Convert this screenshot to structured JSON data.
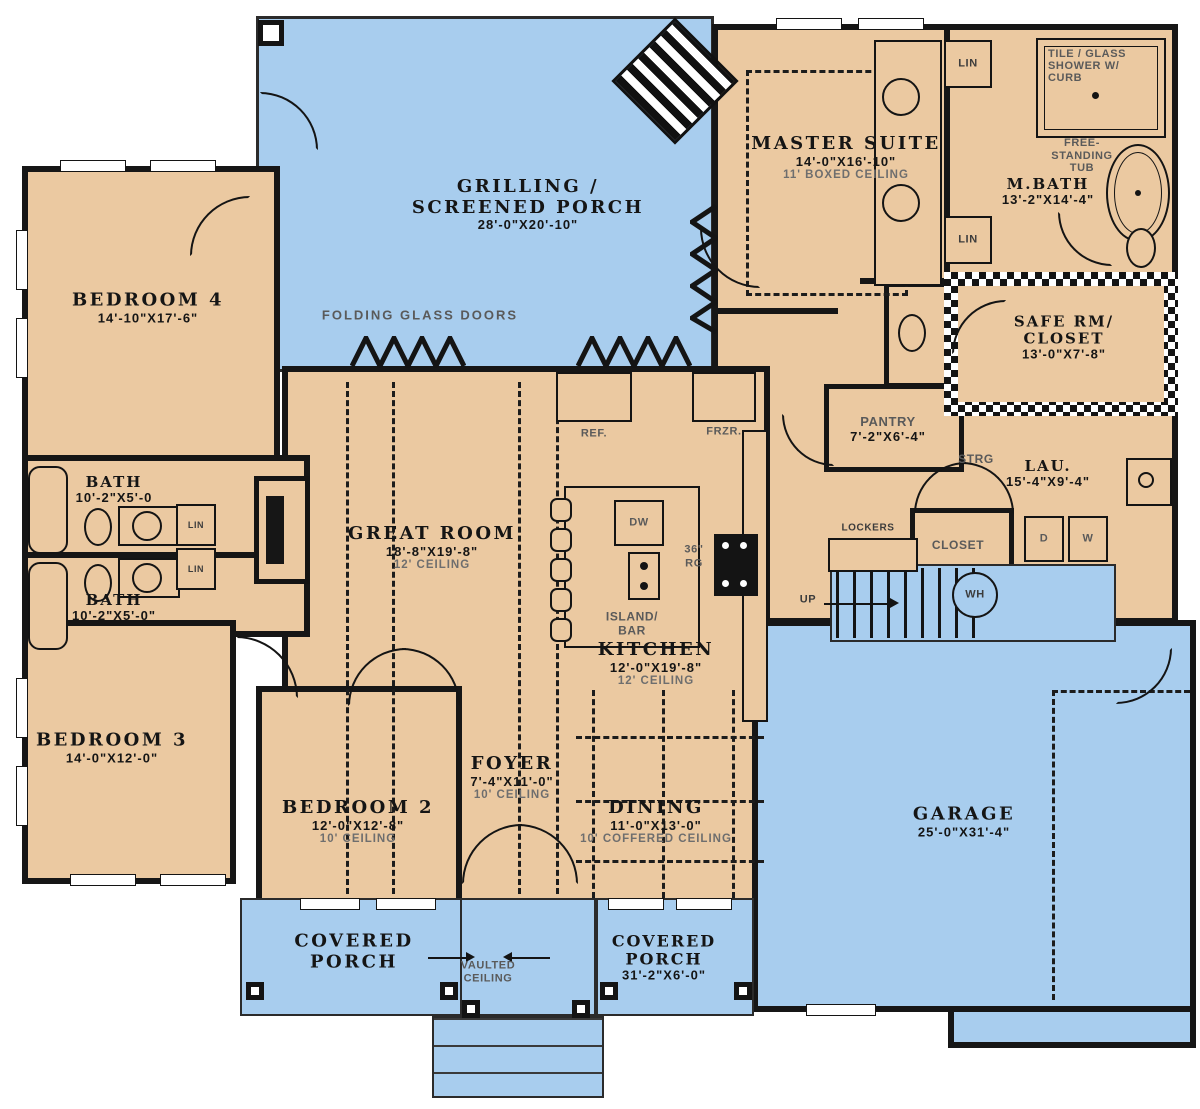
{
  "colors": {
    "interior": "#ebc9a1",
    "outdoor": "#a8cdee",
    "wall": "#161616",
    "ceiling_note": "#6e6e6e"
  },
  "rooms": {
    "screened_porch": {
      "name": "GRILLING /",
      "name2": "SCREENED PORCH",
      "dims": "28'-0\"X20'-10\""
    },
    "master_suite": {
      "name": "MASTER SUITE",
      "dims": "14'-0\"X16'-10\"",
      "ceiling": "11' BOXED CEILING"
    },
    "mbath": {
      "name": "M.BATH",
      "dims": "13'-2\"X14'-4\""
    },
    "safe_room": {
      "name": "SAFE RM/",
      "name2": "CLOSET",
      "dims": "13'-0\"X7'-8\""
    },
    "bedroom4": {
      "name": "BEDROOM 4",
      "dims": "14'-10\"X17'-6\""
    },
    "bath_upper": {
      "name": "BATH",
      "dims": "10'-2\"X5'-0"
    },
    "bath_lower": {
      "name": "BATH",
      "dims": "10'-2\"X5'-0\""
    },
    "bedroom3": {
      "name": "BEDROOM 3",
      "dims": "14'-0\"X12'-0\""
    },
    "bedroom2": {
      "name": "BEDROOM 2",
      "dims": "12'-0\"X12'-8\"",
      "ceiling": "10' CEILING"
    },
    "great_room": {
      "name": "GREAT ROOM",
      "dims": "18'-8\"X19'-8\"",
      "ceiling": "12' CEILING"
    },
    "kitchen": {
      "name": "KITCHEN",
      "dims": "12'-0\"X19'-8\"",
      "ceiling": "12' CEILING"
    },
    "island": {
      "name": "ISLAND/",
      "name2": "BAR"
    },
    "pantry": {
      "name": "PANTRY",
      "dims": "7'-2\"X6'-4\""
    },
    "laundry": {
      "name": "LAU.",
      "dims": "15'-4\"X9'-4\""
    },
    "foyer": {
      "name": "FOYER",
      "dims": "7'-4\"X11'-0\"",
      "ceiling": "10' CEILING"
    },
    "dining": {
      "name": "DINING",
      "dims": "11'-0\"X13'-0\"",
      "ceiling": "10' COFFERED CEILING"
    },
    "garage": {
      "name": "GARAGE",
      "dims": "25'-0\"X31'-4\""
    },
    "porch_left": {
      "name": "COVERED",
      "name2": "PORCH"
    },
    "porch_right": {
      "name": "COVERED",
      "name2": "PORCH",
      "dims": "31'-2\"X6'-0\""
    }
  },
  "labels": {
    "folding_doors": "FOLDING GLASS DOORS",
    "vaulted1": "VAULTED",
    "vaulted2": "CEILING",
    "ref": "REF.",
    "frzr": "FRZR.",
    "dw": "DW",
    "rg1": "36\"",
    "rg2": "RG",
    "lin": "LIN",
    "strg": "STRG",
    "lockers": "LOCKERS",
    "closet": "CLOSET",
    "up": "UP",
    "wh": "WH",
    "d": "D",
    "w": "W",
    "shower1": "TILE / GLASS",
    "shower2": "SHOWER W/",
    "shower3": "CURB",
    "tub1": "FREE-",
    "tub2": "STANDING",
    "tub3": "TUB"
  }
}
